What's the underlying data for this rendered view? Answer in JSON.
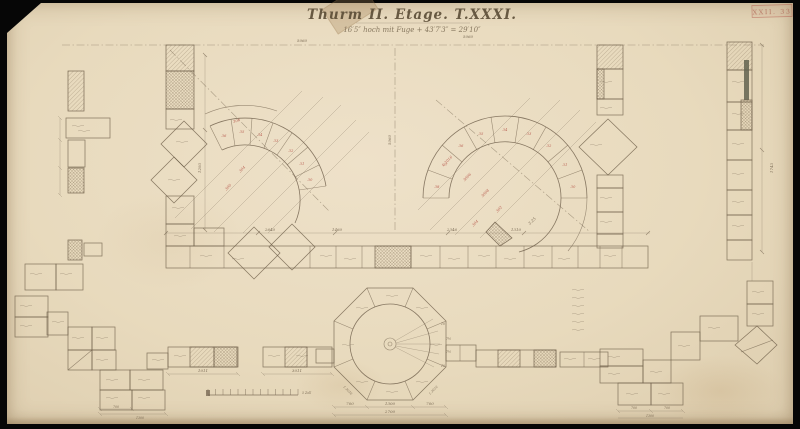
{
  "document": {
    "title": "Thurm II. Etage. T.XXXI.",
    "subtitle": "16′5″ hoch mit Fuge + 43′7′3″ = 29′10″",
    "sub_note": "5060",
    "stamp": "XXII. 33"
  },
  "colors": {
    "paper": "#e8dabd",
    "pencil": "#6d5d48",
    "red_accent": "#b14a3f",
    "ink": "#52442e"
  },
  "dims": {
    "top_edge": "5060",
    "row_a": "2640",
    "row_b": "1460",
    "row_c": "2346",
    "row_d": "1310",
    "vert_center": "5060",
    "vert_left": "1293",
    "vert_right": "1743",
    "strip_a": "1011",
    "strip_b": "3011",
    "oct_l": "700",
    "oct_m": "1300",
    "oct_r": "700",
    "oct_total": "2700",
    "oct_diag_l": "1.3016",
    "oct_diag_r": "1.3016",
    "bl_seg": "700",
    "bl_total": "1300",
    "br_seg1": "700",
    "br_seg2": "700",
    "br_total": "1300",
    "fan2_note": "3.25"
  },
  "fan_left": {
    "blocks": [
      "36",
      "35",
      "34",
      "33",
      "32",
      "31",
      "30"
    ],
    "rays": [
      "306",
      "304",
      "300"
    ]
  },
  "fan_right": {
    "blocks": [
      "38",
      "37",
      "36",
      "35",
      "34",
      "33",
      "32",
      "31",
      "30"
    ],
    "rays": [
      "1.3016",
      "3006",
      "3008",
      "302",
      "304"
    ]
  },
  "tower": {
    "sectors": [
      "10",
      "7½",
      "7½",
      "10"
    ]
  },
  "scale_bar": {
    "label": "5 Zoll"
  }
}
